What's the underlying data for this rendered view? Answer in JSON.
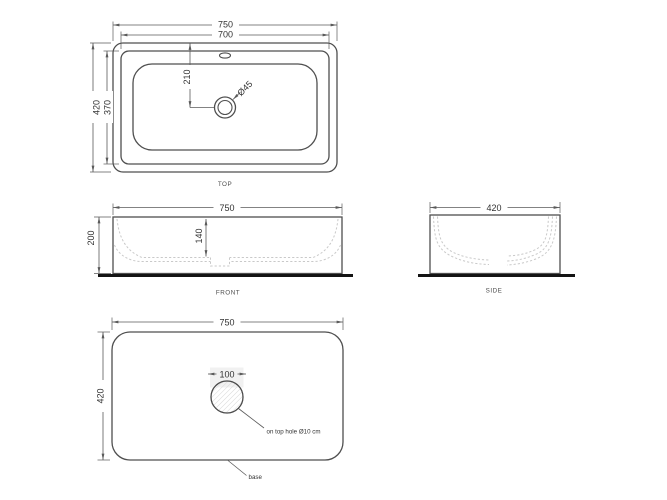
{
  "drawing": {
    "title": "basin technical drawing",
    "colors": {
      "outline": "#4f4f4f",
      "dimension": "#5a5a5a",
      "hidden_line": "#c9c9c9",
      "ground_line": "#141414",
      "text": "#333333",
      "hatch": "#d8d8d8"
    },
    "top_view": {
      "label": "TOP",
      "dim_overall_width": "750",
      "dim_rim_width": "700",
      "dim_overall_depth": "420",
      "dim_rim_depth": "370",
      "dim_drain_offset": "210",
      "dim_drain_diameter": "Ø45"
    },
    "front_view": {
      "label": "FRONT",
      "dim_width": "750",
      "dim_height": "200",
      "dim_inner_depth": "140"
    },
    "side_view": {
      "label": "SIDE",
      "dim_depth": "420"
    },
    "bottom_view": {
      "dim_width": "750",
      "dim_depth": "420",
      "dim_hole": "100",
      "note_hole": "on top hole Ø10 cm",
      "note_base": "base"
    }
  }
}
